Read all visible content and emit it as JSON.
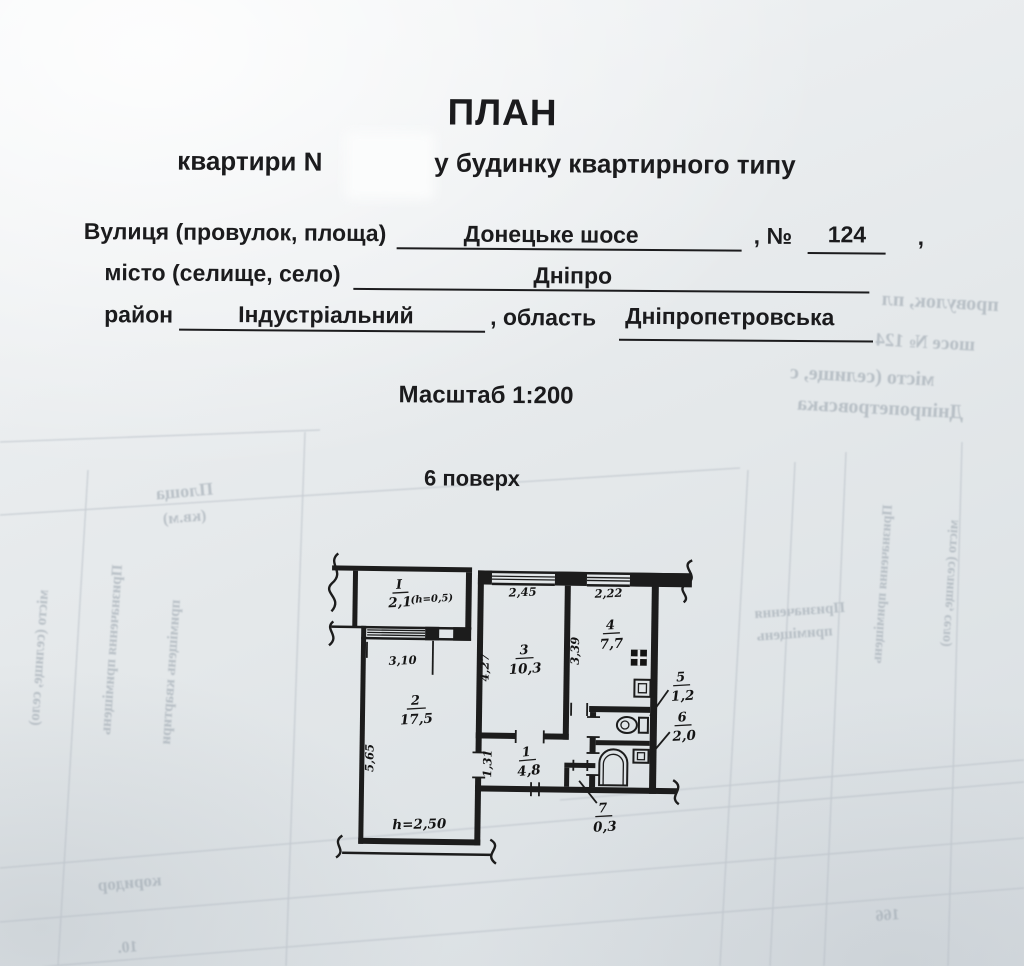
{
  "header": {
    "title": "ПЛАН",
    "subtitle_prefix": "квартири N",
    "subtitle_suffix": "у будинку квартирного типу"
  },
  "address": {
    "street_label": "Вулиця (провулок, площа)",
    "street_value": "Донецьке шосе",
    "number_label": ", №",
    "number_value": "124",
    "trailing_comma": ",",
    "city_label": "місто (селище, село)",
    "city_value": "Дніпро",
    "district_label": "район",
    "district_value": "Індустріальний",
    "region_label": ", область",
    "region_value": "Дніпропетровська"
  },
  "scale": {
    "label": "Масштаб 1:200"
  },
  "floor": {
    "label": "6 поверх"
  },
  "plan": {
    "rooms": [
      {
        "number": "I",
        "area": "2,1",
        "note": "(h=0,5)"
      },
      {
        "number": "2",
        "area": "17,5"
      },
      {
        "number": "3",
        "area": "10,3"
      },
      {
        "number": "4",
        "area": "7,7"
      },
      {
        "number": "5",
        "area": "1,2"
      },
      {
        "number": "6",
        "area": "2,0"
      },
      {
        "number": "7",
        "area": "0,3"
      },
      {
        "number": "1",
        "area": "4,8"
      }
    ],
    "dimensions": {
      "balcony_window": "3,10",
      "room3_window": "2,45",
      "kitchen_window": "2,22",
      "room2_side": "5,65",
      "room3_side": "4,27",
      "kitchen_side": "3,39",
      "hall_width": "1,31",
      "ceiling_height": "h=2,50"
    }
  },
  "bleedthrough": {
    "street_fragment": "провулок, пл",
    "shosse_fragment": "шосе № 124",
    "city_fragment": "місто (селище, с",
    "region_fragment": "Дніпропетровська",
    "area_word": "Площа",
    "area_unit": "(кв.м)",
    "purpose_word": "Призначення",
    "premises_word": "приміщень",
    "corridor_word": "коридор",
    "num_a": "166",
    "num_b": "10.",
    "col1": "Призначення приміщень",
    "col2": "місто (селище, село)",
    "col3": "приміщень квартири"
  }
}
